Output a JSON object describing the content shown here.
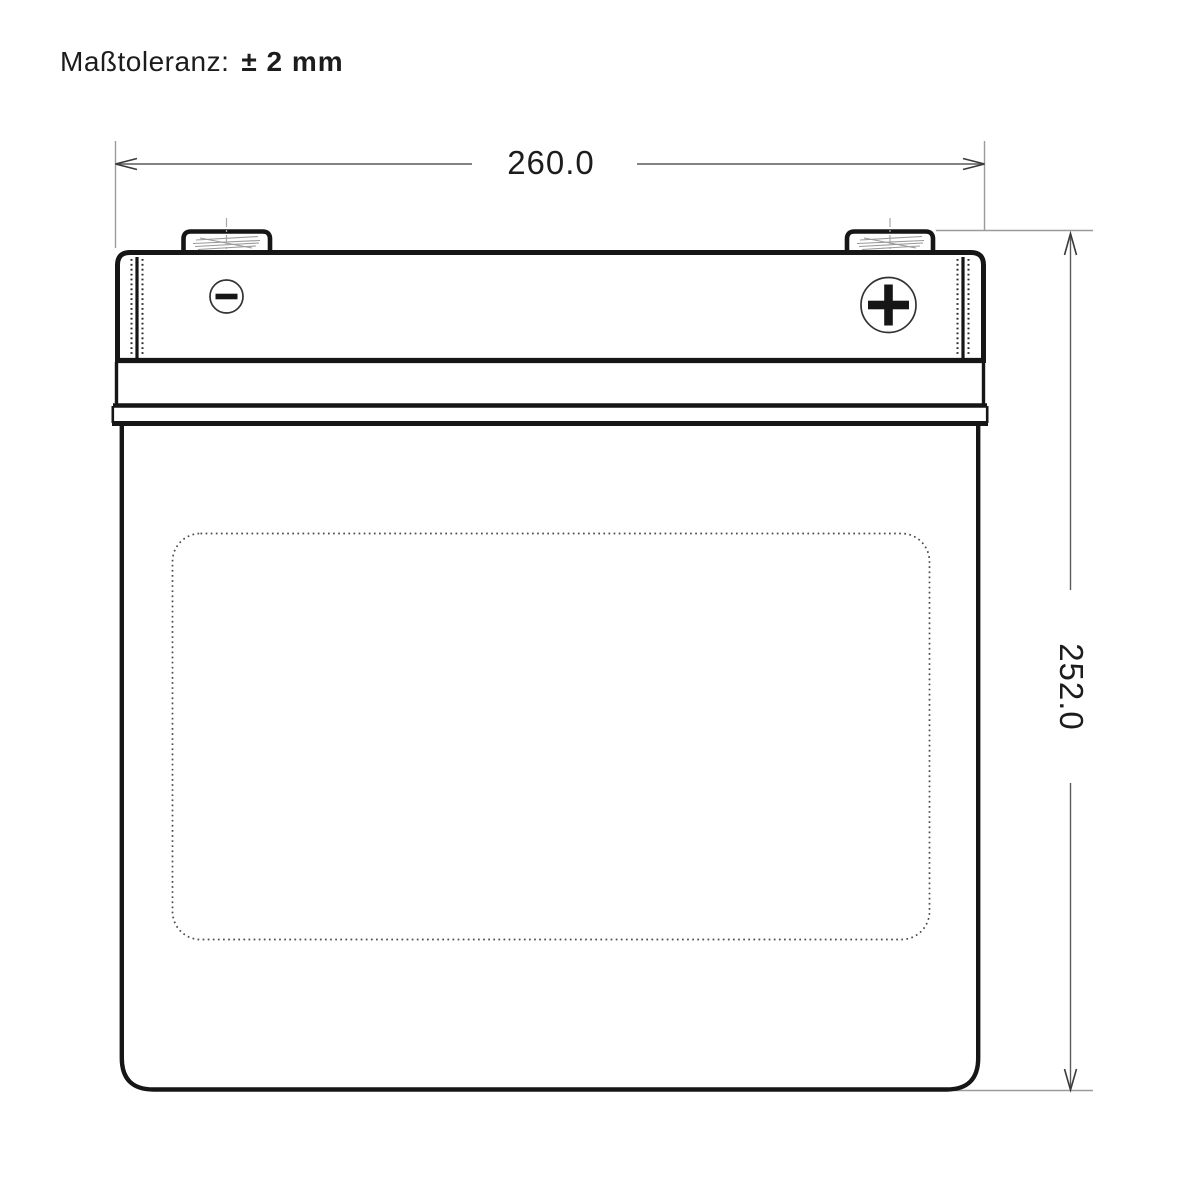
{
  "drawing": {
    "tolerance_note": {
      "label": "Maßtoleranz:",
      "value": "± 2 mm"
    },
    "dimensions": {
      "width_mm": "260.0",
      "height_mm": "252.0"
    },
    "icons": {
      "negative_terminal": "minus-in-circle-icon",
      "positive_terminal": "plus-in-circle-icon"
    },
    "colors": {
      "outline": "#161616",
      "dimension_line": "#5a5a5a",
      "extension_line": "#9a9a9a",
      "hatch_line": "#9a9a9a",
      "text": "#1c1c1c",
      "background": "#ffffff"
    }
  }
}
